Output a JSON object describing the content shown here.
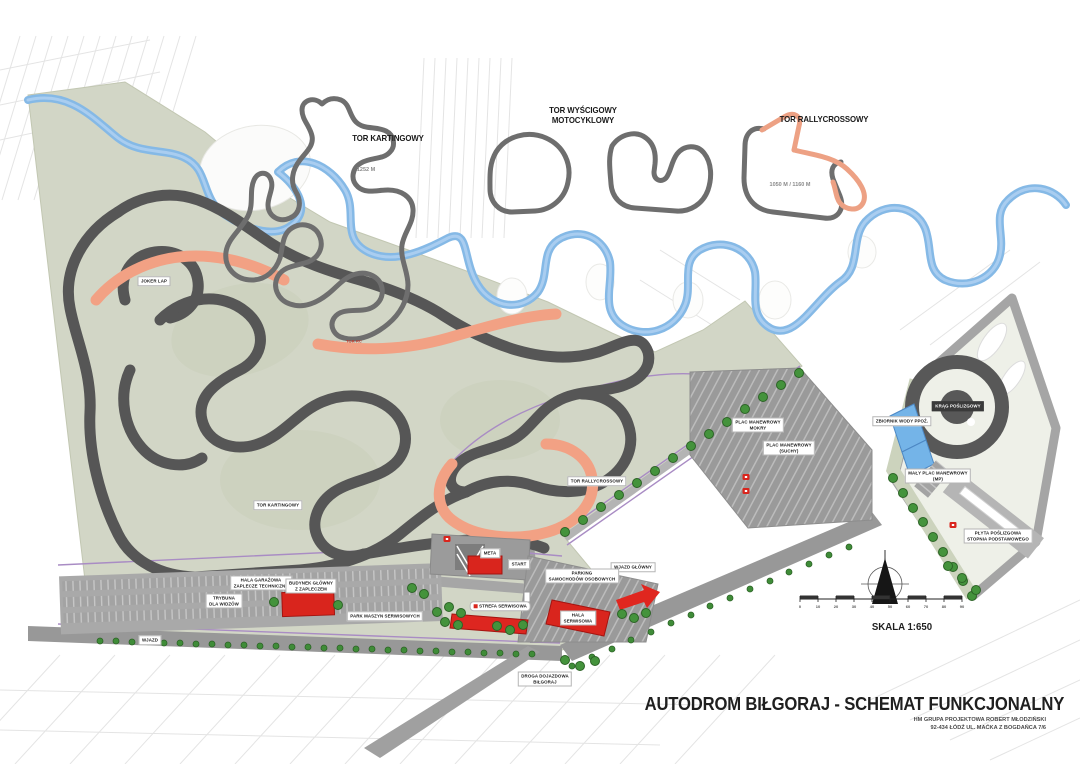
{
  "title_block": {
    "title": "AUTODROM BIŁGORAJ - SCHEMAT FUNKCJONALNY",
    "company_line1": "HM GRUPA PROJEKTOWA ROBERT MŁODZIŃSKI",
    "company_line2": "92-434 ŁÓDŹ UL. MAĆKA Z BOGDAŃCA 7/6"
  },
  "insets": {
    "karting": {
      "title": "TOR KARTINGOWY",
      "length": "1252 M"
    },
    "motorcycle": {
      "title_line1": "TOR WYŚCIGOWY",
      "title_line2": "MOTOCYKLOWY"
    },
    "rallycross": {
      "title": "TOR RALLYCROSSOWY",
      "length": "1050 M / 1160 M"
    }
  },
  "map_labels": {
    "joker_lap": "JOKER LAP",
    "tor_kartingowy": "TOR KARTINGOWY",
    "tor_rallycrossowy": "TOR RALLYCROSSOWY",
    "tor_rc": "TOR RC",
    "plac_mokry_l1": "PLAC MANEWROWY",
    "plac_mokry_l2": "MOKRY",
    "plac_suchy_l1": "PLAC MANEWROWY",
    "plac_suchy_l2": "(SUCHY)",
    "krag_poslizgowy": "KRĄG POŚLIZGOWY",
    "zbiornik_wody": "ZBIORNIK WODY PPOŻ.",
    "maly_plac_l1": "MAŁY PLAC MANEWROWY",
    "maly_plac_l2": "(MP)",
    "plyta_l1": "PŁYTA POŚLIZGOWA",
    "plyta_l2": "STOPNIA PODSTAWOWEGO",
    "meta": "META",
    "start": "START",
    "wjazd_glowny": "WJAZD GŁÓWNY",
    "wjazd_boczny": "WJAZD",
    "parking_l1": "PARKING",
    "parking_l2": "SAMOCHODÓW OSOBOWYCH",
    "hala_l1": "HALA",
    "hala_l2": "SERWISOWA",
    "garaz_l1": "HALA GARAŻOWA",
    "garaz_l2": "ZAPLECZE TECHNICZNE",
    "budynek_l1": "BUDYNEK GŁÓWNY",
    "budynek_l2": "Z ZAPLECZEM",
    "trybuna_l1": "TRYBUNA",
    "trybuna_l2": "DLA WIDZÓW",
    "park_maszyn": "PARK MASZYN SERWISOWYCH",
    "strefa_serwisowa": "STREFA SERWISOWA",
    "droga_l1": "DROGA DOJAZDOWA",
    "droga_l2": "BIŁGORAJ"
  },
  "scale": {
    "label": "SKALA 1:650",
    "ticks": [
      "0",
      "10",
      "20",
      "30",
      "40",
      "50",
      "60",
      "70",
      "80",
      "90"
    ]
  },
  "colors": {
    "track_dark": "#565656",
    "rallycross_orange": "#f2a184",
    "river_blue": "#85b9e6",
    "site_green": "#d2d6c6",
    "road_gray": "#9e9e9e",
    "building_red": "#d9251d",
    "tree_green": "#44933c",
    "fence_purple": "#a98cc4"
  }
}
